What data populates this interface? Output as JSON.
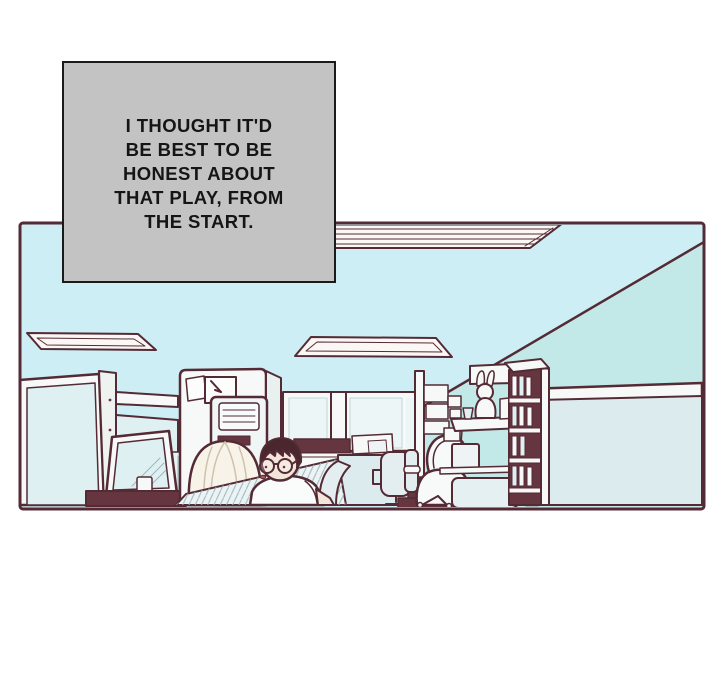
{
  "caption": {
    "text": "I THOUGHT IT'D BE BEST TO BE HONEST ABOUT THAT PLAY, FROM THE START.",
    "lines": [
      "I THOUGHT IT'D",
      "BE BEST TO BE",
      "HONEST ABOUT",
      "THAT PLAY, FROM",
      "THE START."
    ]
  },
  "colors": {
    "page_bg": "#ffffff",
    "caption_bg": "#c3c3c3",
    "caption_border": "#1a1a1a",
    "caption_text": "#151515",
    "line": "#542b35",
    "ceiling": "#cdeef4",
    "wall": "#c2e8e7",
    "paper_white": "#f7f9f8",
    "panel_blue": "#dcecee",
    "screen_blue": "#dff0f3",
    "accent_maroon": "#653540",
    "hair_dark": "#4a262e",
    "hair_blonde": "#f8f3e9",
    "blonde_strand": "#cfc2ab",
    "skin": "#f3e5da",
    "shade_hatch": "#9db6ba",
    "red_detail": "#b5524e"
  },
  "scene": {
    "type": "comic-panel",
    "setting": "office interior with cubicles",
    "objects": [
      "ceiling-light",
      "wall-corner",
      "cubicle-partition",
      "tilted-monitor",
      "wall-clock",
      "tall-cabinet",
      "air-conditioner",
      "window-wall",
      "office-chair",
      "book-row",
      "desk",
      "storage-boxes",
      "wall-shelf",
      "rabbit-figurine",
      "laptop",
      "bookshelf",
      "right-partition"
    ],
    "characters": [
      "blonde-person-back-view",
      "dark-haired-person-with-glasses",
      "hooded-person-at-desk"
    ]
  }
}
